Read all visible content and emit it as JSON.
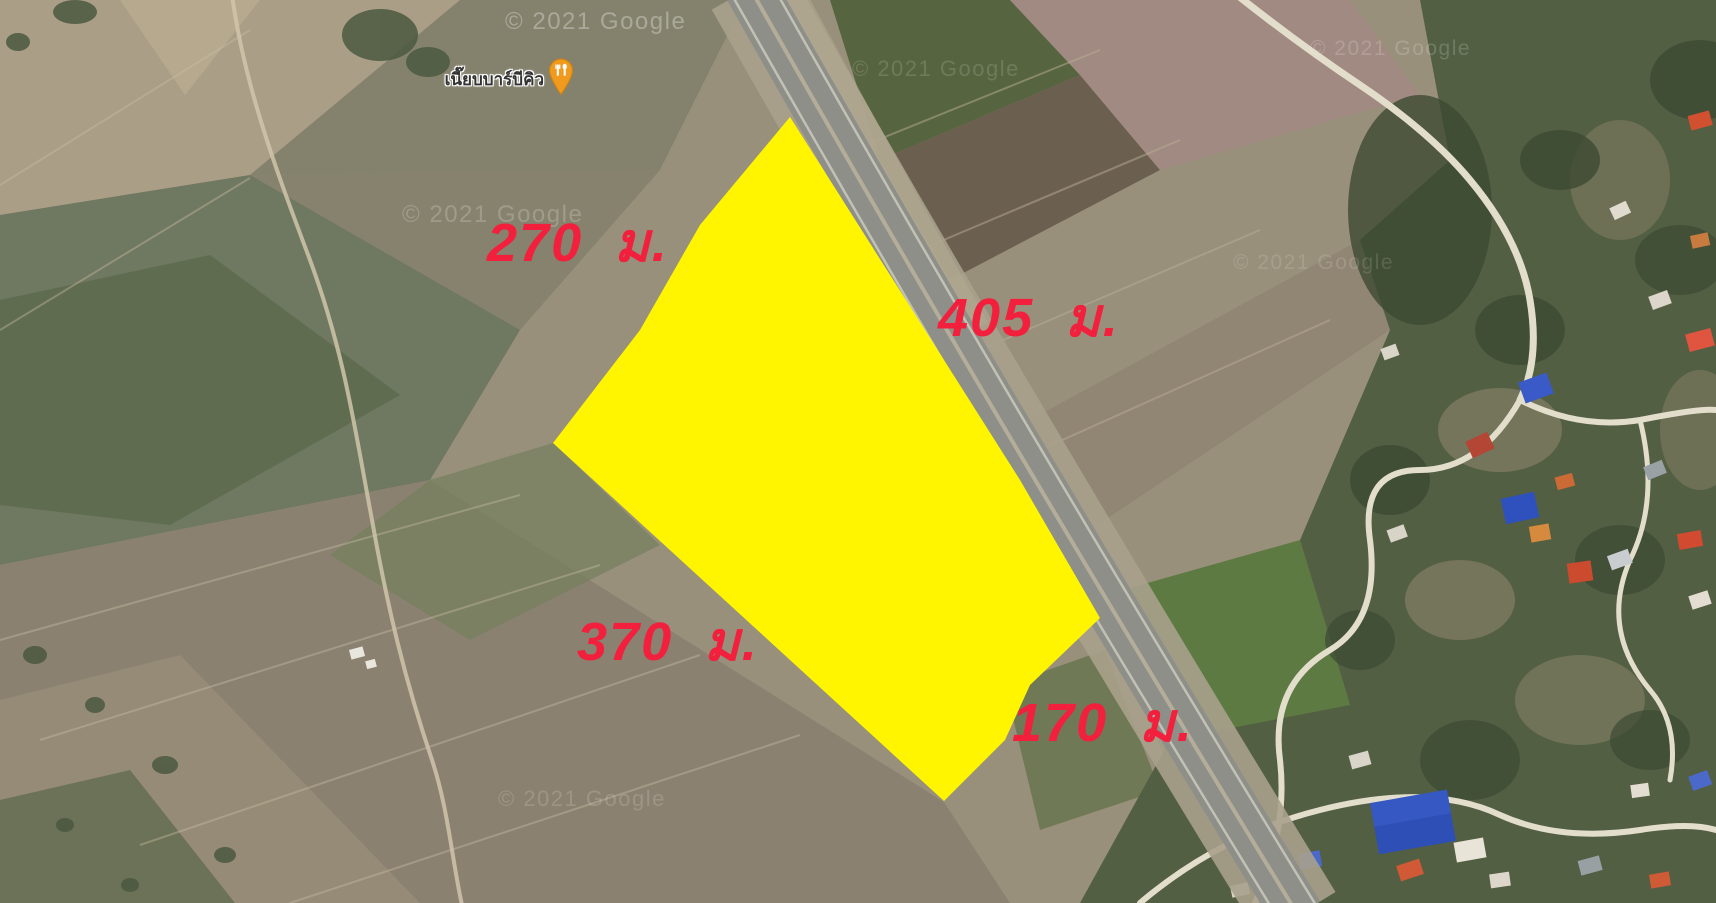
{
  "map_overlay": {
    "parcel": {
      "fill_color": "#FFF500",
      "label_color": "#F2203D",
      "dimension_labels": [
        {
          "id": "northwest-side",
          "text": "270 ม."
        },
        {
          "id": "northeast-side",
          "text": "405 ม."
        },
        {
          "id": "southwest-side",
          "text": "370 ม."
        },
        {
          "id": "southeast-side",
          "text": "170 ม."
        }
      ]
    },
    "poi": {
      "name": "เนี๊ยบบาร์บีคิว",
      "icon": "restaurant-pin-icon",
      "pin_color": "#F09A1E"
    },
    "watermark": {
      "text": "© 2021 Google"
    }
  }
}
